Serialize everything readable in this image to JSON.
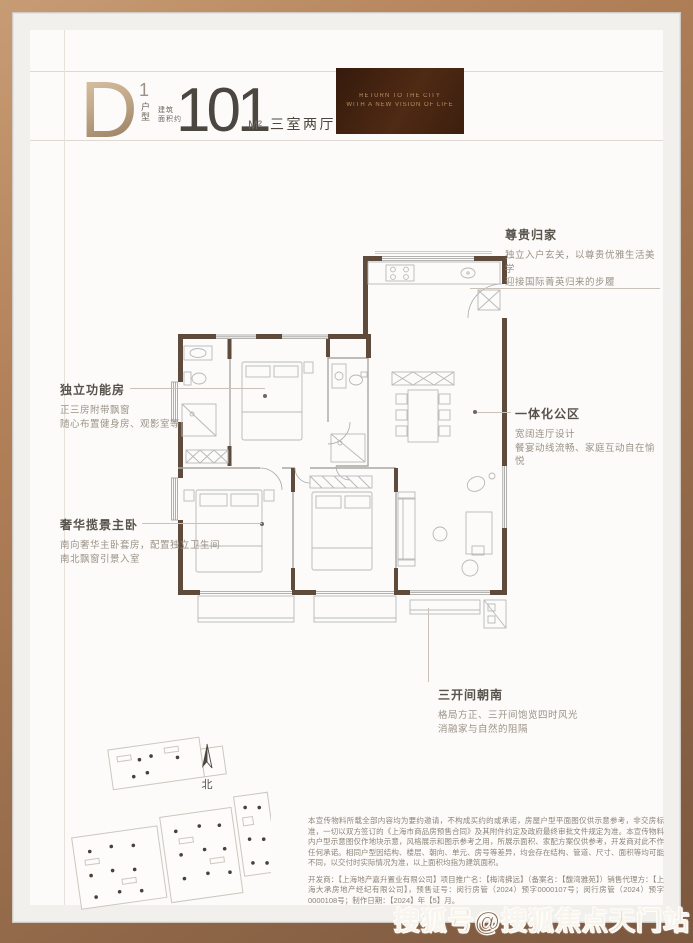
{
  "header": {
    "unit_letter": "D",
    "unit_number": "1",
    "unit_number_label": "户型",
    "area_label_top": "建筑",
    "area_label_bottom": "面积约",
    "area_value": "101",
    "area_unit": "M²",
    "rooms_text": "三室两厅两卫",
    "banner": {
      "line1": "RETURN TO THE CITY",
      "line2": "WITH A NEW VISION OF LIFE"
    }
  },
  "annotations": {
    "left": [
      {
        "title": "独立功能房",
        "line1": "正三房附带飘窗",
        "line2": "随心布置健身房、观影室等"
      },
      {
        "title": "奢华揽景主卧",
        "line1": "南向奢华主卧套房，配置独立卫生间",
        "line2": "南北飘窗引景入室"
      }
    ],
    "right": [
      {
        "title": "尊贵归家",
        "line1": "独立入户玄关，以尊贵优雅生活美学",
        "line2": "迎接国际菁英归来的步履"
      },
      {
        "title": "一体化公区",
        "line1": "宽阔连厅设计",
        "line2": "餐宴动线流畅、家庭互动自在愉悦"
      },
      {
        "title": "三开间朝南",
        "line1": "格局方正、三开间饱览四时风光",
        "line2": "消融家与自然的阻隔"
      }
    ]
  },
  "floorplan": {
    "north_label": "北"
  },
  "disclaimer": {
    "para1": "本宣传物料所载全部内容均为要约邀请，不构成买约的或承诺，房屋户型平面图仅供示意参考，非交房标准，一切以双方签订的《上海市商品房预售合同》及其附件约定及政府最终审批文件规定为准。本宣传物料内户型示意图仅作地块示意，风格展示和图示参考之用，所展示面积、家配方案仅供参考，开发商对此不作任何承诺。相同户型因结构、楼层、朝向、单元、房号等差异，均会存在结构、管道、尺寸、面积等均可能不同，以交付时实际情况为准，以上面积均指为建筑面积。",
    "para2": "开发商：【上海地产嘉升置业有限公司】项目推广名：【梅湾拂远】（备案名：【馥湾雅苑】）销售代理方：【上海大承房地产经纪有限公司】，预售证号：闵行房管（2024）预字0000107号；闵行房管（2024）预字0000108号；制作日期：【2024】年【5】月。"
  },
  "watermark": {
    "text": "搜狐号@搜狐焦点天门站"
  },
  "colors": {
    "frame": "#b28159",
    "banner_brown": "#4f2a14",
    "gold": "#c0a787",
    "text_dark": "#4c4640",
    "text_muted": "#9a9288",
    "wall": "#5e4b3c"
  }
}
